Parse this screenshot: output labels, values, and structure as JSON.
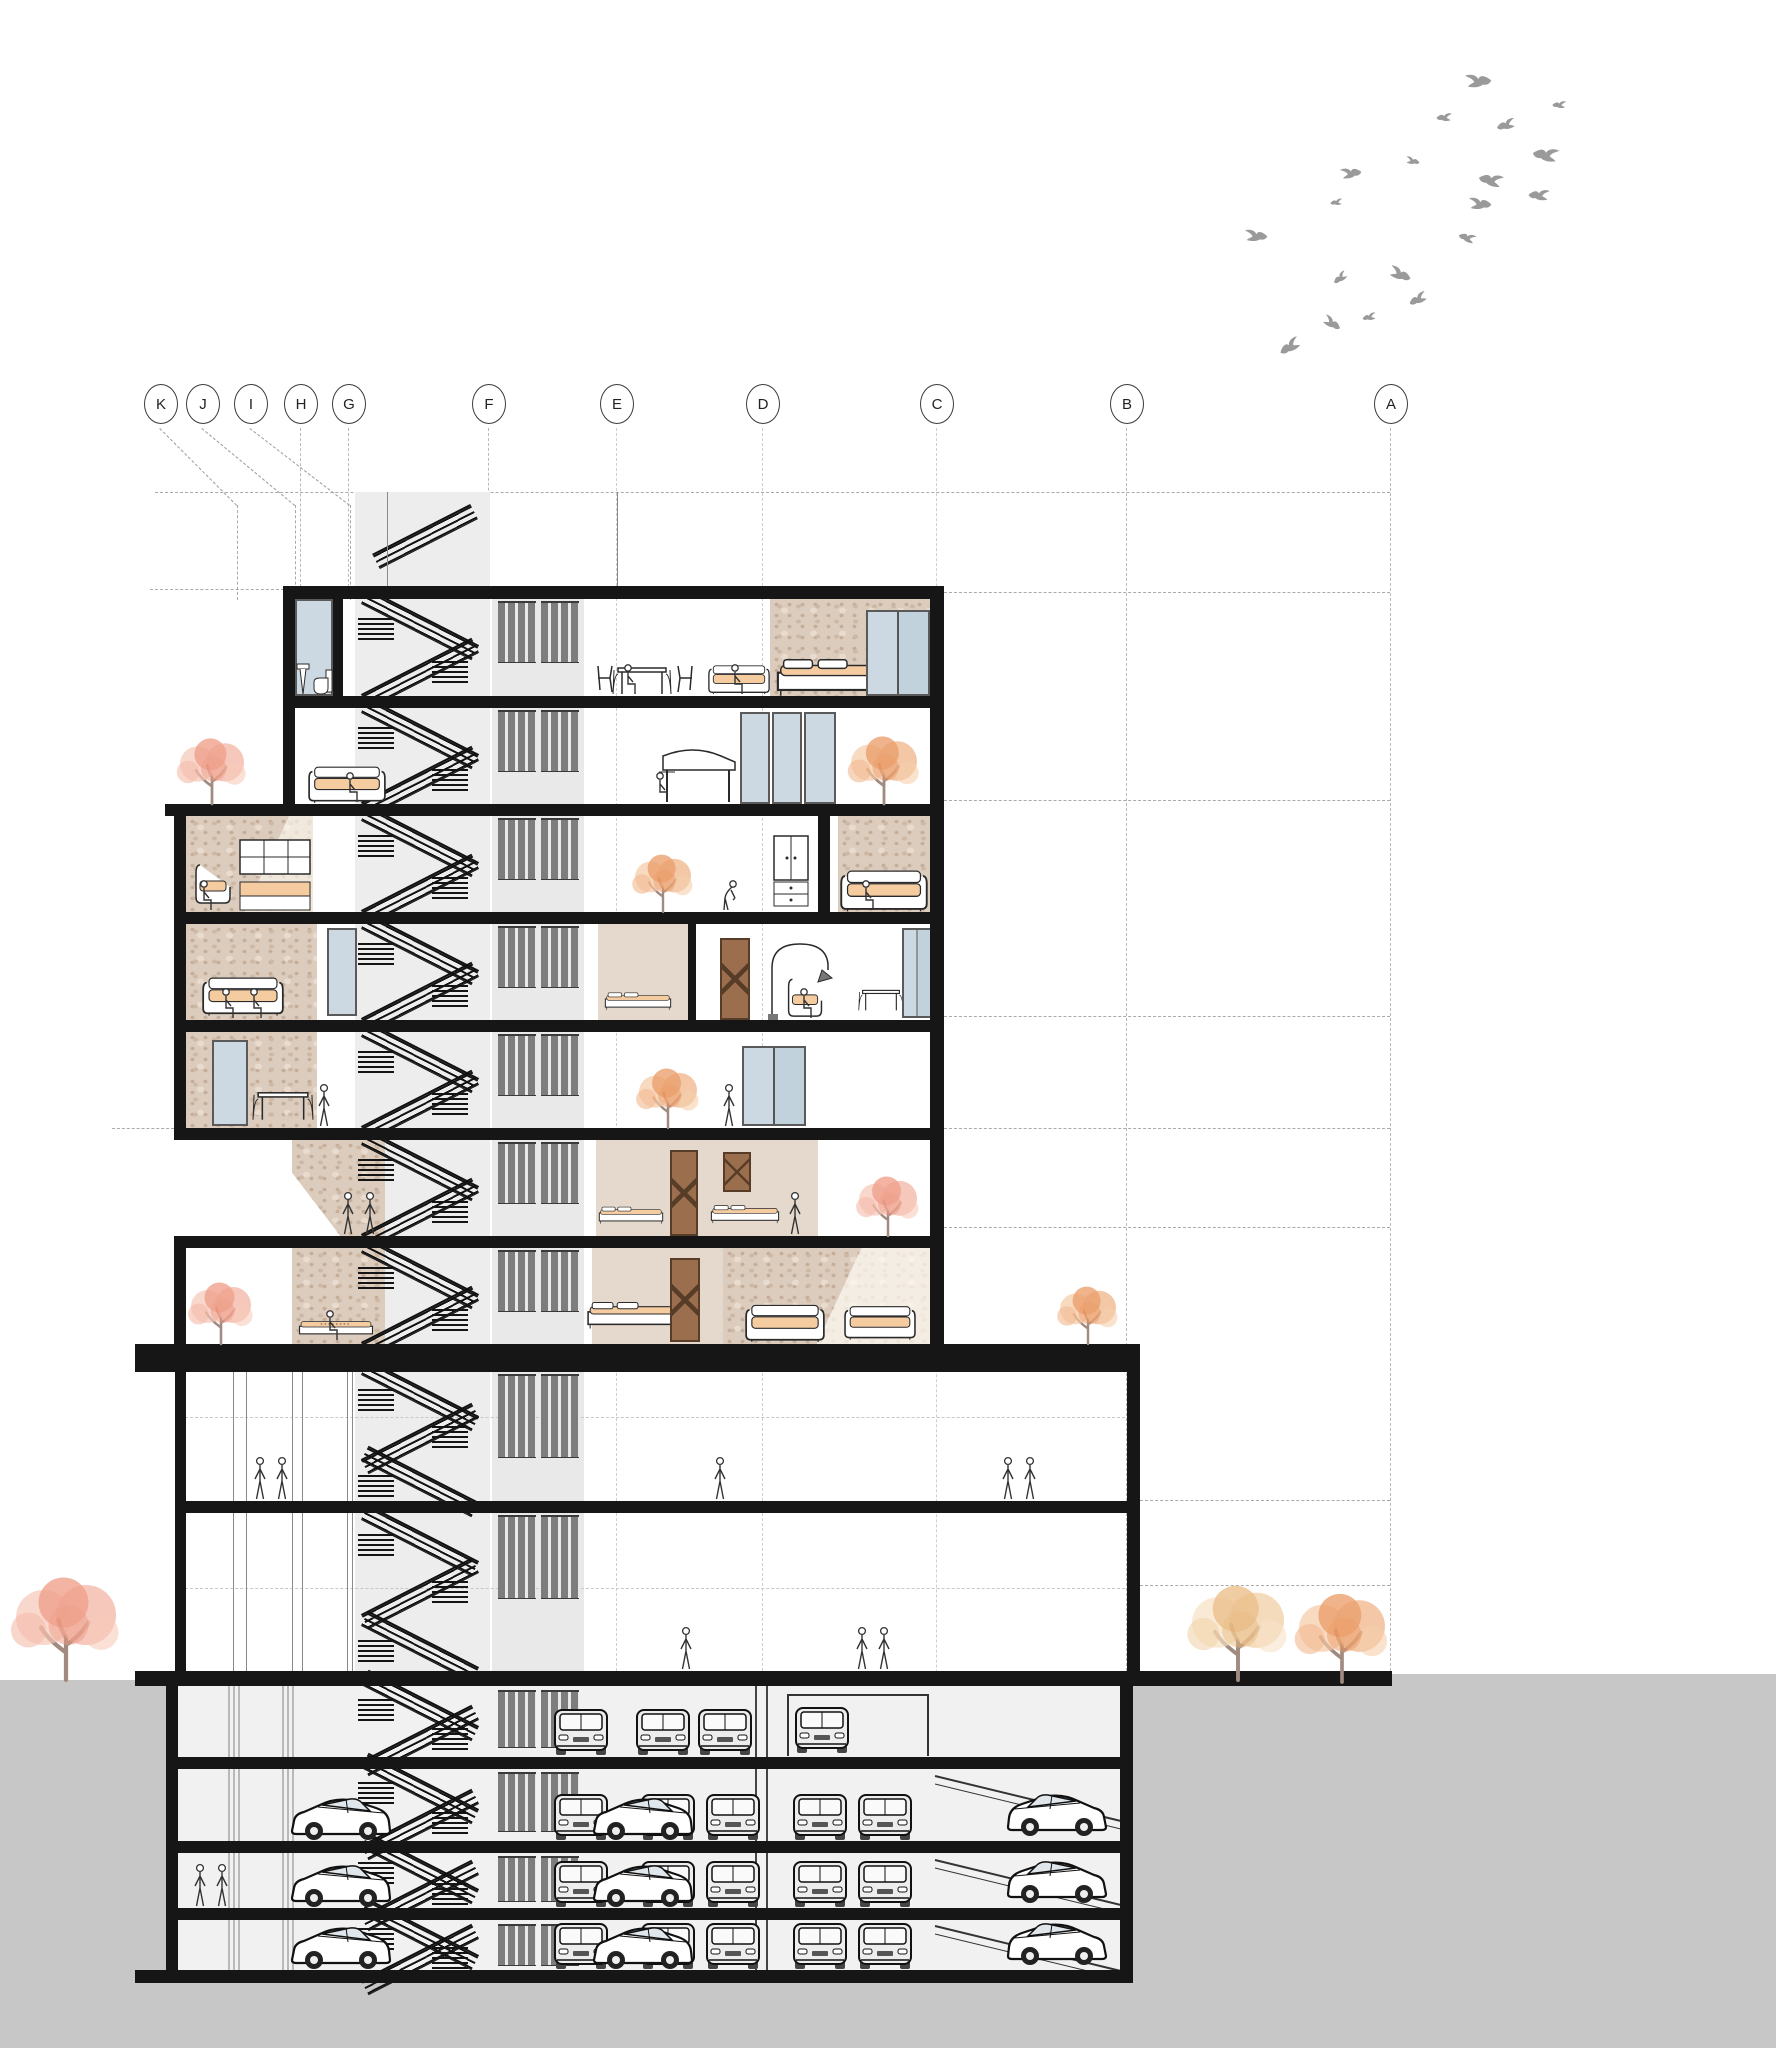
{
  "title": "Residential tower — cross section drawing",
  "grid": {
    "bubble_y": 410,
    "bubble_r": 16,
    "labels": [
      {
        "id": "K",
        "x": 160
      },
      {
        "id": "J",
        "x": 202
      },
      {
        "id": "I",
        "x": 250
      },
      {
        "id": "H",
        "x": 300
      },
      {
        "id": "G",
        "x": 348
      },
      {
        "id": "F",
        "x": 488
      },
      {
        "id": "E",
        "x": 616
      },
      {
        "id": "D",
        "x": 762
      },
      {
        "id": "C",
        "x": 936
      },
      {
        "id": "B",
        "x": 1126
      },
      {
        "id": "A",
        "x": 1390
      }
    ]
  },
  "colors": {
    "ink": "#161616",
    "terrain": "#c7c7c7",
    "glass": "#ccd9e2",
    "beige": "#e4d9cc",
    "travertine": "#dcccbd",
    "louver": "#7d7d7d",
    "bird": "#9a9a9a",
    "peach": "#f5cba0",
    "salmon": "#ef9c84",
    "orange": "#eda468",
    "tan": "#ecc79a",
    "trunk": "#a18a7f"
  },
  "birds": [
    {
      "x": 1462,
      "y": 72,
      "s": 30,
      "r": -15,
      "m": 1
    },
    {
      "x": 1436,
      "y": 112,
      "s": 18,
      "r": 10,
      "m": 0
    },
    {
      "x": 1496,
      "y": 118,
      "s": 22,
      "r": -5,
      "m": 0
    },
    {
      "x": 1532,
      "y": 146,
      "s": 30,
      "r": 20,
      "m": 0
    },
    {
      "x": 1404,
      "y": 156,
      "s": 16,
      "r": 0,
      "m": 1
    },
    {
      "x": 1338,
      "y": 166,
      "s": 24,
      "r": -20,
      "m": 1
    },
    {
      "x": 1478,
      "y": 172,
      "s": 28,
      "r": 25,
      "m": 0
    },
    {
      "x": 1466,
      "y": 196,
      "s": 26,
      "r": -10,
      "m": 1
    },
    {
      "x": 1528,
      "y": 188,
      "s": 24,
      "r": 15,
      "m": 0
    },
    {
      "x": 1330,
      "y": 198,
      "s": 14,
      "r": 5,
      "m": 0
    },
    {
      "x": 1242,
      "y": 228,
      "s": 26,
      "r": -10,
      "m": 1
    },
    {
      "x": 1458,
      "y": 232,
      "s": 20,
      "r": 30,
      "m": 0
    },
    {
      "x": 1332,
      "y": 272,
      "s": 18,
      "r": -25,
      "m": 0
    },
    {
      "x": 1386,
      "y": 266,
      "s": 26,
      "r": 10,
      "m": 1
    },
    {
      "x": 1408,
      "y": 292,
      "s": 22,
      "r": -15,
      "m": 0
    },
    {
      "x": 1320,
      "y": 316,
      "s": 22,
      "r": 20,
      "m": 1
    },
    {
      "x": 1362,
      "y": 312,
      "s": 16,
      "r": 0,
      "m": 0
    },
    {
      "x": 1278,
      "y": 338,
      "s": 26,
      "r": -20,
      "m": 0
    },
    {
      "x": 1552,
      "y": 100,
      "s": 16,
      "r": 12,
      "m": 0
    }
  ],
  "trees": [
    {
      "x": 212,
      "y": 804,
      "w": 84,
      "h": 64,
      "c": "salmon"
    },
    {
      "x": 663,
      "y": 912,
      "w": 76,
      "h": 56,
      "c": "orange"
    },
    {
      "x": 884,
      "y": 804,
      "w": 108,
      "h": 66,
      "c": "orange"
    },
    {
      "x": 668,
      "y": 1128,
      "w": 90,
      "h": 58,
      "c": "orange"
    },
    {
      "x": 888,
      "y": 1236,
      "w": 78,
      "h": 58,
      "c": "salmon"
    },
    {
      "x": 221,
      "y": 1344,
      "w": 86,
      "h": 60,
      "c": "salmon"
    },
    {
      "x": 1088,
      "y": 1344,
      "w": 78,
      "h": 56,
      "c": "orange"
    },
    {
      "x": 66,
      "y": 1680,
      "w": 140,
      "h": 100,
      "c": "salmon"
    },
    {
      "x": 1238,
      "y": 1680,
      "w": 128,
      "h": 92,
      "c": "tan"
    },
    {
      "x": 1342,
      "y": 1682,
      "w": 122,
      "h": 86,
      "c": "orange"
    }
  ],
  "people": [
    {
      "x": 630,
      "y": 696,
      "pose": "sit"
    },
    {
      "x": 737,
      "y": 696,
      "pose": "sit"
    },
    {
      "x": 352,
      "y": 804,
      "pose": "sit"
    },
    {
      "x": 662,
      "y": 804,
      "pose": "sit"
    },
    {
      "x": 206,
      "y": 912,
      "pose": "sit"
    },
    {
      "x": 728,
      "y": 912,
      "pose": "bend"
    },
    {
      "x": 868,
      "y": 912,
      "pose": "sit"
    },
    {
      "x": 228,
      "y": 1020,
      "pose": "sit"
    },
    {
      "x": 256,
      "y": 1020,
      "pose": "sit"
    },
    {
      "x": 806,
      "y": 1020,
      "pose": "sit"
    },
    {
      "x": 324,
      "y": 1128,
      "pose": "stand"
    },
    {
      "x": 729,
      "y": 1128,
      "pose": "stand"
    },
    {
      "x": 348,
      "y": 1236,
      "pose": "stand"
    },
    {
      "x": 370,
      "y": 1236,
      "pose": "stand"
    },
    {
      "x": 795,
      "y": 1236,
      "pose": "stand"
    },
    {
      "x": 332,
      "y": 1342,
      "pose": "sit"
    },
    {
      "x": 260,
      "y": 1501,
      "pose": "stand"
    },
    {
      "x": 282,
      "y": 1501,
      "pose": "stand"
    },
    {
      "x": 720,
      "y": 1501,
      "pose": "stand"
    },
    {
      "x": 1008,
      "y": 1501,
      "pose": "stand"
    },
    {
      "x": 1030,
      "y": 1501,
      "pose": "stand"
    },
    {
      "x": 686,
      "y": 1671,
      "pose": "stand"
    },
    {
      "x": 862,
      "y": 1671,
      "pose": "stand"
    },
    {
      "x": 884,
      "y": 1671,
      "pose": "stand"
    },
    {
      "x": 200,
      "y": 1908,
      "pose": "stand"
    },
    {
      "x": 222,
      "y": 1908,
      "pose": "stand"
    }
  ],
  "cars": {
    "front": [
      {
        "x": 553,
        "y": 1756
      },
      {
        "x": 635,
        "y": 1756
      },
      {
        "x": 697,
        "y": 1756
      },
      {
        "x": 794,
        "y": 1754
      },
      {
        "x": 553,
        "y": 1841
      },
      {
        "x": 640,
        "y": 1841
      },
      {
        "x": 705,
        "y": 1841
      },
      {
        "x": 792,
        "y": 1841
      },
      {
        "x": 857,
        "y": 1841
      },
      {
        "x": 553,
        "y": 1908
      },
      {
        "x": 640,
        "y": 1908
      },
      {
        "x": 705,
        "y": 1908
      },
      {
        "x": 792,
        "y": 1908
      },
      {
        "x": 857,
        "y": 1908
      },
      {
        "x": 553,
        "y": 1970
      },
      {
        "x": 640,
        "y": 1970
      },
      {
        "x": 705,
        "y": 1970
      },
      {
        "x": 792,
        "y": 1970
      },
      {
        "x": 857,
        "y": 1970
      }
    ],
    "side": [
      {
        "x": 288,
        "y": 1841,
        "m": 0
      },
      {
        "x": 288,
        "y": 1908,
        "m": 0
      },
      {
        "x": 288,
        "y": 1970,
        "m": 0
      },
      {
        "x": 590,
        "y": 1841,
        "m": 0
      },
      {
        "x": 590,
        "y": 1908,
        "m": 0
      },
      {
        "x": 590,
        "y": 1970,
        "m": 0
      },
      {
        "x": 1006,
        "y": 1837,
        "m": 1
      },
      {
        "x": 1006,
        "y": 1904,
        "m": 1
      },
      {
        "x": 1006,
        "y": 1966,
        "m": 1
      }
    ]
  },
  "parking": {
    "garage_frame": {
      "x": 787,
      "y": 1694,
      "w": 142,
      "h": 62
    },
    "ramps": [
      {
        "y": 1772
      },
      {
        "y": 1856
      },
      {
        "y": 1922
      }
    ]
  },
  "furniture": [
    {
      "type": "glasswall",
      "x": 295,
      "y": 599,
      "w": 38,
      "h": 97
    },
    {
      "type": "toilet",
      "x": 312,
      "y": 668,
      "w": 22,
      "h": 28
    },
    {
      "type": "sink",
      "x": 296,
      "y": 662,
      "w": 14,
      "h": 34
    },
    {
      "type": "table",
      "x": 606,
      "y": 652,
      "w": 72,
      "h": 44
    },
    {
      "type": "sofa",
      "x": 708,
      "y": 655,
      "w": 62,
      "h": 41
    },
    {
      "type": "bed",
      "x": 775,
      "y": 658,
      "w": 144,
      "h": 38
    },
    {
      "type": "window",
      "x": 866,
      "y": 610,
      "w": 64,
      "h": 86
    },
    {
      "type": "sofa",
      "x": 308,
      "y": 755,
      "w": 78,
      "h": 49
    },
    {
      "type": "piano",
      "x": 645,
      "y": 738,
      "w": 96,
      "h": 66
    },
    {
      "type": "foldglass",
      "x": 740,
      "y": 712,
      "w": 96,
      "h": 92
    },
    {
      "type": "chairP",
      "x": 192,
      "y": 842,
      "w": 44,
      "h": 70
    },
    {
      "type": "shelfbed",
      "x": 238,
      "y": 838,
      "w": 74,
      "h": 74
    },
    {
      "type": "wardrobe",
      "x": 772,
      "y": 834,
      "w": 38,
      "h": 78
    },
    {
      "type": "sofa",
      "x": 840,
      "y": 858,
      "w": 88,
      "h": 54
    },
    {
      "type": "sofa",
      "x": 202,
      "y": 962,
      "w": 82,
      "h": 58
    },
    {
      "type": "glasswall",
      "x": 327,
      "y": 928,
      "w": 30,
      "h": 88
    },
    {
      "type": "bed",
      "x": 604,
      "y": 982,
      "w": 68,
      "h": 38
    },
    {
      "type": "door",
      "x": 720,
      "y": 938,
      "w": 30,
      "h": 82
    },
    {
      "type": "arclamp",
      "x": 766,
      "y": 940,
      "w": 66,
      "h": 80
    },
    {
      "type": "chairP",
      "x": 784,
      "y": 962,
      "w": 44,
      "h": 58
    },
    {
      "type": "table",
      "x": 858,
      "y": 972,
      "w": 46,
      "h": 46
    },
    {
      "type": "window",
      "x": 902,
      "y": 928,
      "w": 30,
      "h": 90
    },
    {
      "type": "glasswall",
      "x": 212,
      "y": 1040,
      "w": 36,
      "h": 86
    },
    {
      "type": "table",
      "x": 252,
      "y": 1072,
      "w": 62,
      "h": 54
    },
    {
      "type": "window",
      "x": 742,
      "y": 1046,
      "w": 64,
      "h": 80
    },
    {
      "type": "bed",
      "x": 598,
      "y": 1196,
      "w": 66,
      "h": 38
    },
    {
      "type": "door",
      "x": 670,
      "y": 1150,
      "w": 28,
      "h": 86
    },
    {
      "type": "bed",
      "x": 710,
      "y": 1194,
      "w": 70,
      "h": 40
    },
    {
      "type": "door",
      "x": 723,
      "y": 1152,
      "w": 28,
      "h": 40
    },
    {
      "type": "daybed",
      "x": 298,
      "y": 1312,
      "w": 76,
      "h": 30
    },
    {
      "type": "bed",
      "x": 586,
      "y": 1288,
      "w": 104,
      "h": 54
    },
    {
      "type": "door",
      "x": 670,
      "y": 1258,
      "w": 30,
      "h": 84
    },
    {
      "type": "sofa",
      "x": 736,
      "y": 1294,
      "w": 98,
      "h": 48
    },
    {
      "type": "sofa",
      "x": 844,
      "y": 1294,
      "w": 72,
      "h": 48
    }
  ]
}
